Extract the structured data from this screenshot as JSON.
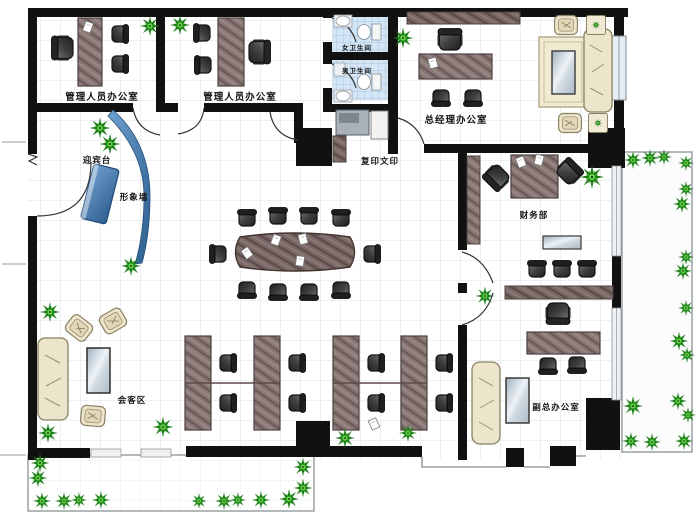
{
  "floor_plan": {
    "rooms": {
      "office_admin_1": {
        "label": "管理人员办公室"
      },
      "office_admin_2": {
        "label": "管理人员办公室"
      },
      "restroom_women": {
        "label": "女卫生间"
      },
      "restroom_men": {
        "label": "男卫生间"
      },
      "gm_office": {
        "label": "总经理办公室"
      },
      "copy_print": {
        "label": "复印文印"
      },
      "reception": {
        "label": "迎宾台"
      },
      "image_wall": {
        "label": "形象墙"
      },
      "finance": {
        "label": "财务部"
      },
      "guest_area": {
        "label": "会客区"
      },
      "deputy_gm_office": {
        "label": "副总办公室"
      }
    },
    "colors": {
      "wall": "#111111",
      "wood": "#8a7876",
      "wood_dark": "#6d5b59",
      "chair": "#3f3f3f",
      "sofa_beige": "#ece4cb",
      "accent_blue": "#4d82b8",
      "plant_green": "#2fa824",
      "tile_blue": "#d4e6f6",
      "glass": "#cfd9e0"
    }
  }
}
